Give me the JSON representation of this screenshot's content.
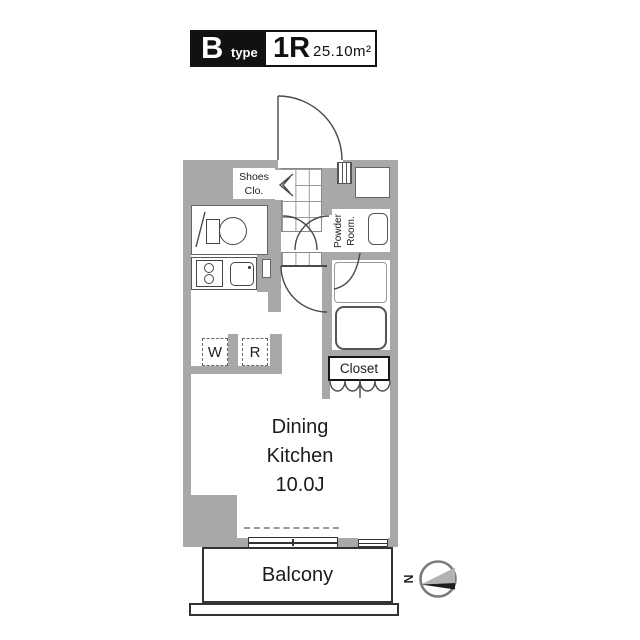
{
  "title_block": {
    "type_letter": "B",
    "type_word": "type",
    "layout": "1R",
    "area": "25.10m²"
  },
  "plan": {
    "shoes_closet": {
      "line1": "Shoes",
      "line2": "Clo."
    },
    "powder_room": {
      "line1": "Powder",
      "line2": "Room."
    },
    "closet": "Closet",
    "washer": "W",
    "refrigerator": "R",
    "dining_kitchen": {
      "line1": "Dining",
      "line2": "Kitchen",
      "line3": "10.0J"
    },
    "balcony": "Balcony"
  },
  "compass": {
    "north": "N"
  },
  "colors": {
    "wall_gray": "#a8a8a8",
    "outline": "#4a4a4a",
    "title_black": "#111111",
    "background": "#ffffff"
  }
}
